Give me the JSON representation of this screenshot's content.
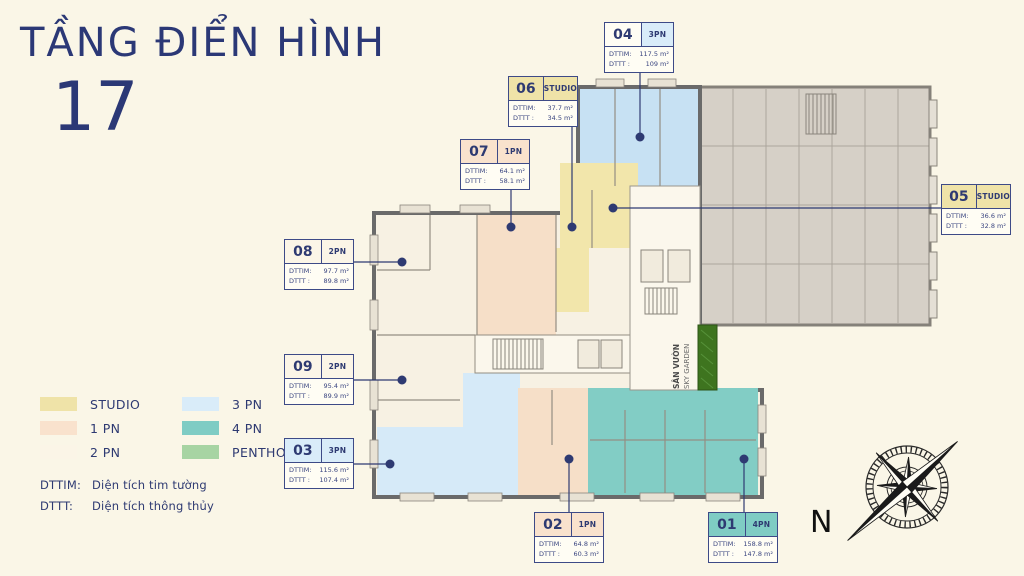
{
  "title": {
    "text": "TẦNG ĐIỂN HÌNH",
    "floor_number": "17"
  },
  "callout_labels": {
    "dttim": "DTTIM:",
    "dttt": "DTTT :"
  },
  "callouts": [
    {
      "code": "01",
      "type": "4PN",
      "dttim": "158.8 m²",
      "dttt": "147.8 m²",
      "type_color": "#7fccc4"
    },
    {
      "code": "02",
      "type": "1PN",
      "dttim": "64.8 m²",
      "dttt": "60.3 m²",
      "type_color": "#f9e2cd"
    },
    {
      "code": "03",
      "type": "3PN",
      "dttim": "115.6 m²",
      "dttt": "107.4 m²",
      "type_color": "#d9ecf9"
    },
    {
      "code": "04",
      "type": "3PN",
      "dttim": "117.5 m²",
      "dttt": "109 m²",
      "type_color": "#d9ecf9"
    },
    {
      "code": "05",
      "type": "STUDIO",
      "dttim": "36.6 m²",
      "dttt": "32.8 m²",
      "type_color": "#efe3a8"
    },
    {
      "code": "06",
      "type": "STUDIO",
      "dttim": "37.7 m²",
      "dttt": "34.5 m²",
      "type_color": "#efe3a8"
    },
    {
      "code": "07",
      "type": "1PN",
      "dttim": "64.1 m²",
      "dttt": "58.1 m²",
      "type_color": "#f9e2cd"
    },
    {
      "code": "08",
      "type": "2PN",
      "dttim": "97.7 m²",
      "dttt": "89.8 m²",
      "type_color": "#fbf5e7"
    },
    {
      "code": "09",
      "type": "2PN",
      "dttim": "95.4 m²",
      "dttt": "89.9 m²",
      "type_color": "#fbf5e7"
    }
  ],
  "legend": {
    "items": [
      {
        "label": "STUDIO",
        "color": "#efe3a8"
      },
      {
        "label": "1 PN",
        "color": "#f9e2cd"
      },
      {
        "label": "2 PN",
        "color": "#fbf5e7"
      },
      {
        "label": "3 PN",
        "color": "#d9ecf9"
      },
      {
        "label": "4 PN",
        "color": "#7fccc4"
      },
      {
        "label": "PENTHOUSE",
        "color": "#a7d4a3"
      }
    ],
    "notes": [
      {
        "abbr": "DTTIM:",
        "text": "Diện tích tim tường"
      },
      {
        "abbr": "DTTT:",
        "text": "Diện tích thông thủy"
      }
    ]
  },
  "plan": {
    "sky_garden_line1": "SÂN VƯỜN",
    "sky_garden_line2": "SKY GARDEN"
  },
  "compass": {
    "north": "N"
  },
  "colors": {
    "background": "#faf6e7",
    "accent_navy": "#2e3a72",
    "plan_unit_blue": "#c7e1f3",
    "plan_unit_yellow": "#f2e6ab",
    "plan_unit_peach": "#f6dfc8",
    "plan_unit_teal": "#82cdc5",
    "plan_gray_block": "#d6d0c7",
    "sky_garden_green": "#3e741f"
  }
}
